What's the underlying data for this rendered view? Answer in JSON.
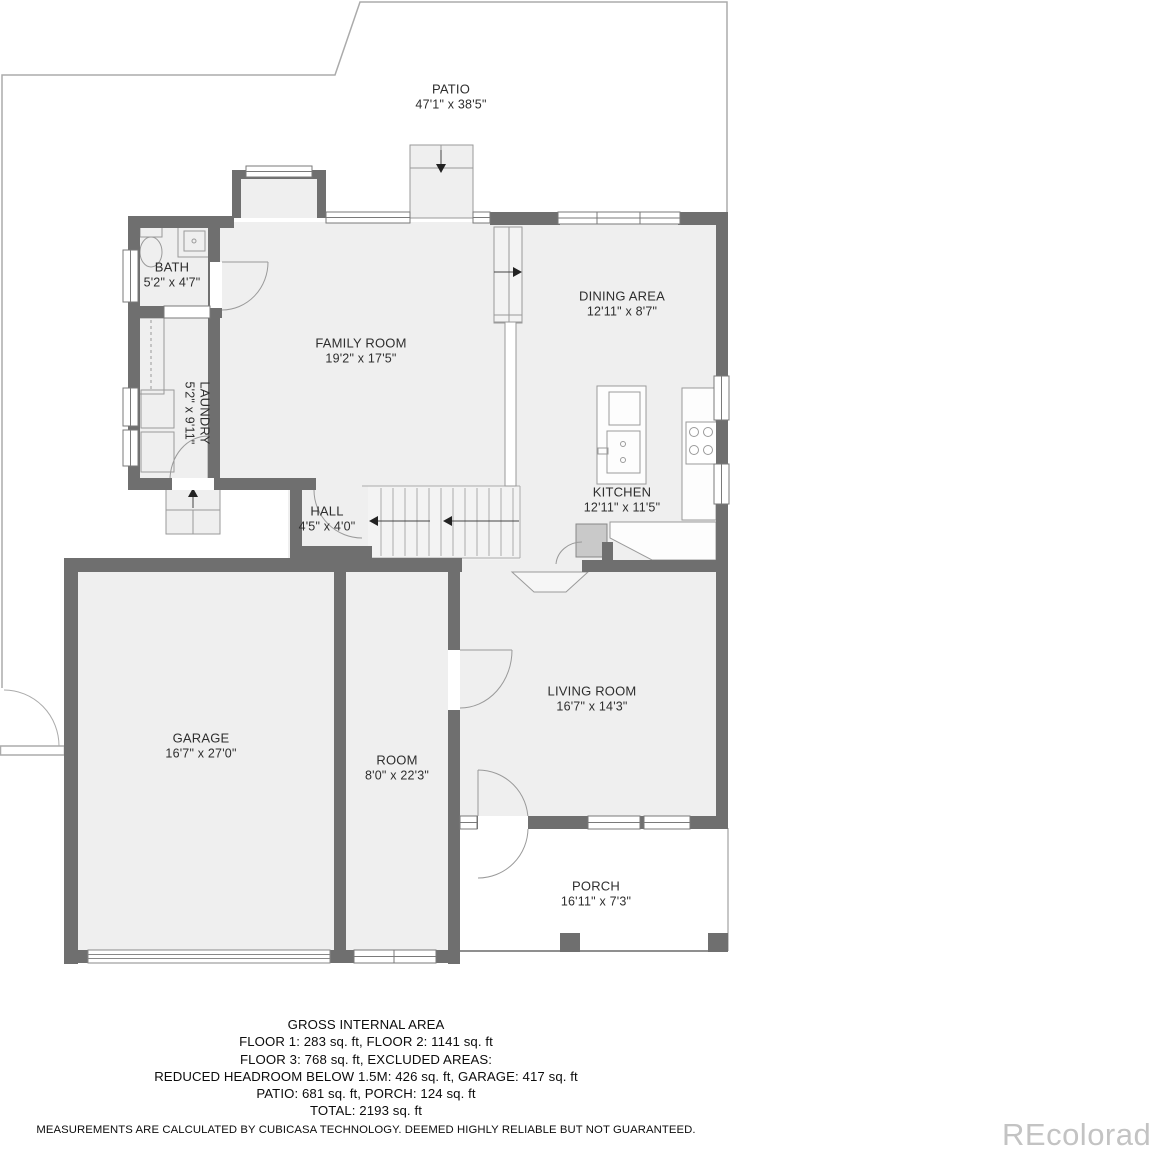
{
  "watermark": "REcolorado",
  "rooms": [
    {
      "name": "PATIO",
      "dims": "47'1\" x 38'5\""
    },
    {
      "name": "BATH",
      "dims": "5'2\" x 4'7\""
    },
    {
      "name": "FAMILY ROOM",
      "dims": "19'2\" x 17'5\""
    },
    {
      "name": "DINING AREA",
      "dims": "12'11\" x 8'7\""
    },
    {
      "name": "LAUNDRY",
      "dims": "5'2\" x 9'11\""
    },
    {
      "name": "HALL",
      "dims": "4'5\" x 4'0\""
    },
    {
      "name": "KITCHEN",
      "dims": "12'11\" x 11'5\""
    },
    {
      "name": "GARAGE",
      "dims": "16'7\" x 27'0\""
    },
    {
      "name": "ROOM",
      "dims": "8'0\" x 22'3\""
    },
    {
      "name": "LIVING ROOM",
      "dims": "16'7\" x 14'3\""
    },
    {
      "name": "PORCH",
      "dims": "16'11\" x 7'3\""
    }
  ],
  "footer": {
    "title": "GROSS INTERNAL AREA",
    "line1": "FLOOR 1: 283 sq. ft, FLOOR 2: 1141 sq. ft",
    "line2": "FLOOR 3: 768 sq. ft, EXCLUDED AREAS:",
    "line3": "REDUCED HEADROOM BELOW 1.5M: 426 sq. ft, GARAGE: 417 sq. ft",
    "line4": "PATIO: 681 sq. ft, PORCH: 124 sq. ft",
    "line5": "TOTAL: 2193 sq. ft",
    "disclaimer": "MEASUREMENTS ARE CALCULATED BY CUBICASA TECHNOLOGY. DEEMED HIGHLY RELIABLE BUT NOT GUARANTEED."
  }
}
